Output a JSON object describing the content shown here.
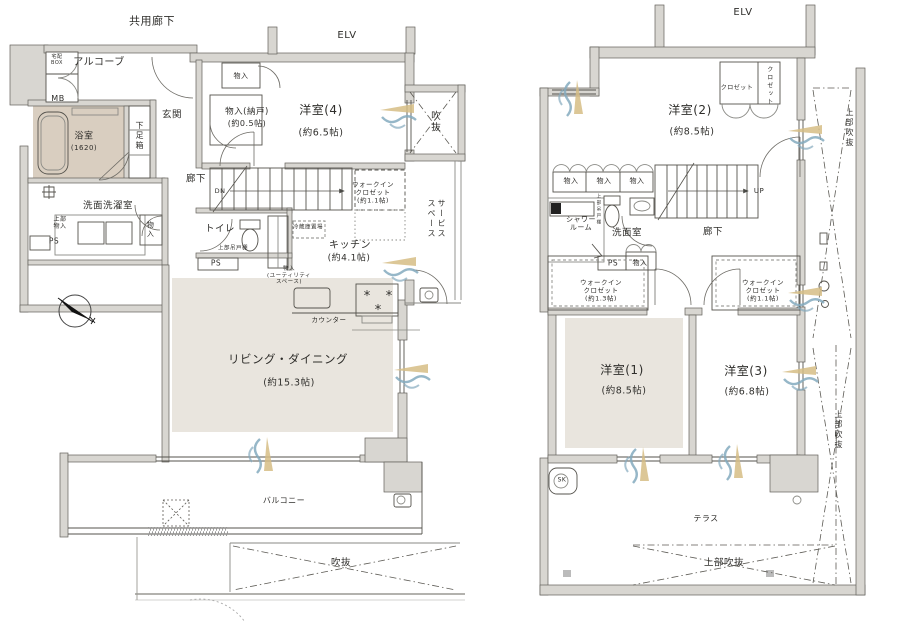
{
  "document_type": "apartment floor plan (two levels)",
  "colors": {
    "background": "#ffffff",
    "wall_fill": "#d8d6d1",
    "wall_stroke": "#62605a",
    "line": "#4a4a46",
    "thin_line": "#8a8a85",
    "room_beige": "#e9e5de",
    "bath_beige": "#d9cec0",
    "breeze_tan": "#d6bd85",
    "breeze_blue": "#84aabe",
    "text": "#2f2e2b"
  },
  "plans": [
    {
      "id": "lower-floor",
      "labels": [
        {
          "id": "common-corridor",
          "text": "共用廊下",
          "x": 152,
          "y": 21,
          "size": 11
        },
        {
          "id": "elevator-lower",
          "text": "ELV",
          "x": 347,
          "y": 36,
          "size": 10
        },
        {
          "id": "alcove",
          "text": "アルコーブ",
          "x": 99,
          "y": 63,
          "size": 10
        },
        {
          "id": "delivery-box",
          "text": "宅配\nBOX",
          "x": 57,
          "y": 60,
          "size": 5
        },
        {
          "id": "meter-box",
          "text": "MB",
          "x": 58,
          "y": 99,
          "size": 8
        },
        {
          "id": "bathroom",
          "text": "浴室",
          "x": 84,
          "y": 137,
          "size": 9
        },
        {
          "id": "bathroom-size",
          "text": "(1620)",
          "x": 84,
          "y": 148,
          "size": 7
        },
        {
          "id": "shoe-cabinet",
          "text": "下足箱",
          "x": 139,
          "y": 136,
          "size": 8,
          "v": true
        },
        {
          "id": "entrance",
          "text": "玄関",
          "x": 172,
          "y": 115,
          "size": 9.5
        },
        {
          "id": "storage-top",
          "text": "物入",
          "x": 241,
          "y": 76,
          "size": 7
        },
        {
          "id": "storage-nando",
          "text": "物入(納戸)",
          "x": 247,
          "y": 112,
          "size": 8.5
        },
        {
          "id": "storage-nando-size",
          "text": "(約0.5帖)",
          "x": 247,
          "y": 124,
          "size": 8
        },
        {
          "id": "bedroom4",
          "text": "洋室(4)",
          "x": 321,
          "y": 110,
          "size": 12
        },
        {
          "id": "bedroom4-size",
          "text": "(約6.5帖)",
          "x": 321,
          "y": 133,
          "size": 9.5
        },
        {
          "id": "void-upper-right",
          "text": "吹抜",
          "x": 434,
          "y": 122,
          "size": 9.5,
          "v": true
        },
        {
          "id": "hallway-lower",
          "text": "廊下",
          "x": 196,
          "y": 179,
          "size": 9.5
        },
        {
          "id": "stairs-down",
          "text": "DN",
          "x": 220,
          "y": 192,
          "size": 6.5
        },
        {
          "id": "wic-lower",
          "text": "ウォークイン\nクロゼット\n(約1.1帖)",
          "x": 373,
          "y": 193,
          "size": 6.5
        },
        {
          "id": "service-space",
          "text": "サービス\nスペース",
          "x": 436,
          "y": 219,
          "size": 8,
          "v": true
        },
        {
          "id": "toilet",
          "text": "トイレ",
          "x": 220,
          "y": 229,
          "size": 9.5
        },
        {
          "id": "upper-cupboard-toilet",
          "text": "上部吊戸棚",
          "x": 233,
          "y": 249,
          "size": 5.5
        },
        {
          "id": "ps-toilet",
          "text": "PS",
          "x": 216,
          "y": 263,
          "size": 7.5
        },
        {
          "id": "fridge-space",
          "text": "冷蔵庫置場",
          "x": 308,
          "y": 228,
          "size": 5.5
        },
        {
          "id": "kitchen",
          "text": "キッチン",
          "x": 350,
          "y": 246,
          "size": 10
        },
        {
          "id": "kitchen-size",
          "text": "(約4.1帖)",
          "x": 349,
          "y": 259,
          "size": 9
        },
        {
          "id": "utility-storage",
          "text": "物入\n(ユーティリティ\nスペース)",
          "x": 289,
          "y": 276,
          "size": 5.5
        },
        {
          "id": "counter",
          "text": "カウンター",
          "x": 329,
          "y": 321,
          "size": 6.5
        },
        {
          "id": "laundry-room",
          "text": "洗面洗濯室",
          "x": 108,
          "y": 206,
          "size": 9.5
        },
        {
          "id": "upper-storage",
          "text": "上部\n物入",
          "x": 60,
          "y": 223,
          "size": 6
        },
        {
          "id": "ps-laundry",
          "text": "PS",
          "x": 54,
          "y": 241,
          "size": 7.5
        },
        {
          "id": "storage-laundry",
          "text": "物入",
          "x": 150,
          "y": 230,
          "size": 7,
          "v": true
        },
        {
          "id": "living-dining",
          "text": "リビング・ダイニング",
          "x": 288,
          "y": 360,
          "size": 11.5
        },
        {
          "id": "living-dining-size",
          "text": "(約15.3帖)",
          "x": 289,
          "y": 383,
          "size": 9.5
        },
        {
          "id": "balcony",
          "text": "バルコニー",
          "x": 284,
          "y": 501,
          "size": 8
        },
        {
          "id": "void-bottom",
          "text": "吹抜",
          "x": 341,
          "y": 563,
          "size": 9.5
        }
      ]
    },
    {
      "id": "upper-floor",
      "labels": [
        {
          "id": "elevator-upper",
          "text": "ELV",
          "x": 743,
          "y": 13,
          "size": 10
        },
        {
          "id": "bedroom2",
          "text": "洋室(2)",
          "x": 690,
          "y": 110,
          "size": 12
        },
        {
          "id": "bedroom2-size",
          "text": "(約8.5帖)",
          "x": 692,
          "y": 132,
          "size": 9.5
        },
        {
          "id": "closet-h",
          "text": "クロゼット",
          "x": 737,
          "y": 88,
          "size": 6
        },
        {
          "id": "closet-v",
          "text": "クロゼット",
          "x": 769,
          "y": 86,
          "size": 6,
          "v": true
        },
        {
          "id": "void-top-right",
          "text": "上部吹抜",
          "x": 849,
          "y": 128,
          "size": 8,
          "v": true
        },
        {
          "id": "storage-a",
          "text": "物入",
          "x": 571,
          "y": 181,
          "size": 7
        },
        {
          "id": "storage-b",
          "text": "物入",
          "x": 604,
          "y": 181,
          "size": 7
        },
        {
          "id": "storage-c",
          "text": "物入",
          "x": 637,
          "y": 181,
          "size": 7
        },
        {
          "id": "stairs-up",
          "text": "UP",
          "x": 759,
          "y": 191,
          "size": 7
        },
        {
          "id": "shower-room",
          "text": "シャワー\nルーム",
          "x": 581,
          "y": 224,
          "size": 7
        },
        {
          "id": "upper-cupboard-wash",
          "text": "上部吊戸棚",
          "x": 598,
          "y": 210,
          "size": 4.5,
          "v": true
        },
        {
          "id": "washroom",
          "text": "洗面室",
          "x": 627,
          "y": 233,
          "size": 9.5
        },
        {
          "id": "hallway-upper",
          "text": "廊下",
          "x": 713,
          "y": 232,
          "size": 9.5
        },
        {
          "id": "ps-upper",
          "text": "PS",
          "x": 613,
          "y": 263,
          "size": 7.5
        },
        {
          "id": "storage-wash",
          "text": "物入",
          "x": 640,
          "y": 263,
          "size": 7
        },
        {
          "id": "wic-13",
          "text": "ウォークイン\nクロゼット\n(約1.3帖)",
          "x": 601,
          "y": 291,
          "size": 6.5
        },
        {
          "id": "wic-11",
          "text": "ウォークイン\nクロゼット\n(約1.1帖)",
          "x": 763,
          "y": 291,
          "size": 6.5
        },
        {
          "id": "bedroom1",
          "text": "洋室(1)",
          "x": 622,
          "y": 370,
          "size": 12
        },
        {
          "id": "bedroom1-size",
          "text": "(約8.5帖)",
          "x": 624,
          "y": 391,
          "size": 9.5
        },
        {
          "id": "bedroom3",
          "text": "洋室(3)",
          "x": 746,
          "y": 371,
          "size": 12
        },
        {
          "id": "bedroom3-size",
          "text": "(約6.8帖)",
          "x": 747,
          "y": 392,
          "size": 9.5
        },
        {
          "id": "slop-sink",
          "text": "SK",
          "x": 562,
          "y": 480,
          "size": 6
        },
        {
          "id": "terrace",
          "text": "テラス",
          "x": 706,
          "y": 519,
          "size": 8
        },
        {
          "id": "void-bottom-upper",
          "text": "上部吹抜",
          "x": 724,
          "y": 563,
          "size": 9.5
        },
        {
          "id": "void-right-upper",
          "text": "上部吹抜",
          "x": 838,
          "y": 430,
          "size": 8,
          "v": true
        }
      ]
    }
  ]
}
